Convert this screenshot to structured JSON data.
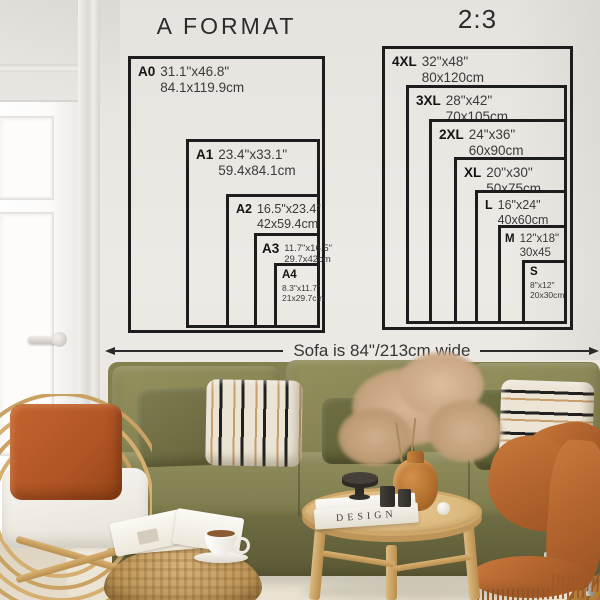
{
  "titles": {
    "a_format": "A FORMAT",
    "ratio": "2:3"
  },
  "a_sizes": [
    {
      "label": "A0",
      "inches": "31.1\"x46.8\"",
      "cm": "84.1x119.9cm"
    },
    {
      "label": "A1",
      "inches": "23.4\"x33.1\"",
      "cm": "59.4x84.1cm"
    },
    {
      "label": "A2",
      "inches": "16.5\"x23.4\"",
      "cm": "42x59.4cm"
    },
    {
      "label": "A3",
      "inches": "11.7\"x16.5\"",
      "cm": "29.7x42cm"
    },
    {
      "label": "A4",
      "inches": "8.3\"x11.7\"",
      "cm": "21x29.7cm"
    }
  ],
  "b_sizes": [
    {
      "label": "4XL",
      "inches": "32\"x48\"",
      "cm": "80x120cm"
    },
    {
      "label": "3XL",
      "inches": "28\"x42\"",
      "cm": "70x105cm"
    },
    {
      "label": "2XL",
      "inches": "24\"x36\"",
      "cm": "60x90cm"
    },
    {
      "label": "XL",
      "inches": "20\"x30\"",
      "cm": "50x75cm"
    },
    {
      "label": "L",
      "inches": "16\"x24\"",
      "cm": "40x60cm"
    },
    {
      "label": "M",
      "inches": "12\"x18\"",
      "cm": "30x45"
    },
    {
      "label": "S",
      "inches": "8\"x12\"",
      "cm": "20x30cm"
    }
  ],
  "sofa_note": "Sofa is 84\"/213cm wide",
  "decor": {
    "book_title": "DESIGN"
  },
  "colors": {
    "chart_line": "#1d1d1d",
    "wall": "#e9e6e2",
    "sofa_olive": "#82804e",
    "throw_rust": "#b4662e",
    "rattan": "#c9a263"
  }
}
